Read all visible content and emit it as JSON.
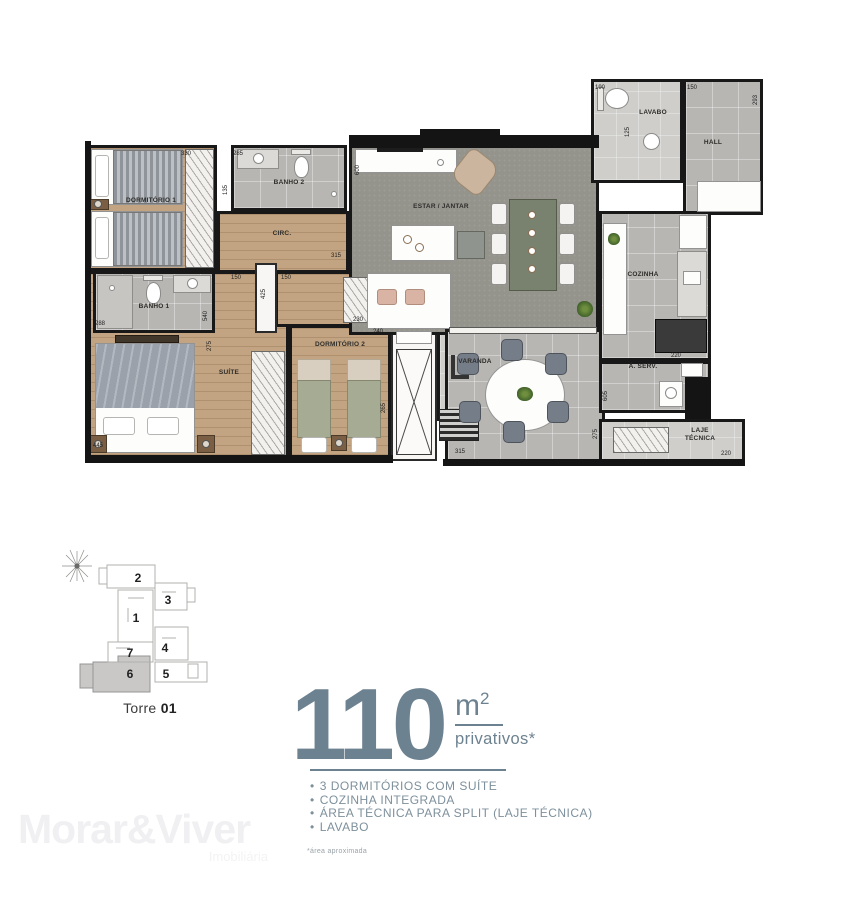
{
  "plan": {
    "rooms": {
      "dorm1": {
        "label": "DORMITÓRIO 1"
      },
      "banho2": {
        "label": "BANHO 2"
      },
      "circ": {
        "label": "CIRC."
      },
      "banho1": {
        "label": "BANHO 1"
      },
      "suite": {
        "label": "SUÍTE"
      },
      "dorm2": {
        "label": "DORMITÓRIO 2"
      },
      "estar": {
        "label": "ESTAR / JANTAR"
      },
      "varanda": {
        "label": "VARANDA"
      },
      "cozinha": {
        "label": "COZINHA"
      },
      "aserv": {
        "label": "Á. SERV."
      },
      "laje": {
        "label": "LAJE TÉCNICA"
      },
      "lavabo": {
        "label": "LAVABO"
      },
      "hall": {
        "label": "HALL"
      }
    },
    "dims": [
      "330",
      "285",
      "135",
      "288",
      "540",
      "150",
      "425",
      "150",
      "315",
      "600",
      "230",
      "240",
      "265",
      "445",
      "275",
      "190",
      "150",
      "125",
      "293",
      "220",
      "605",
      "315",
      "275",
      "220"
    ]
  },
  "keyplan": {
    "tower_label": "Torre",
    "tower_number": "01",
    "units": [
      "1",
      "2",
      "3",
      "4",
      "5",
      "6",
      "7"
    ],
    "highlighted_unit": "6"
  },
  "area": {
    "value": "110",
    "unit": "m",
    "unit_sup": "2",
    "qualifier": "privativos*"
  },
  "features": [
    "3 DORMITÓRIOS COM SUÍTE",
    "COZINHA INTEGRADA",
    "ÁREA TÉCNICA PARA SPLIT (LAJE TÉCNICA)",
    "LAVABO"
  ],
  "footnote": "*área aproximada",
  "watermark": {
    "brand": "Morar&Viver",
    "tagline": "Imobiliária"
  },
  "colors": {
    "accent": "#6d8290",
    "wall": "#141414",
    "wood": "#c2a482",
    "tile": "#b7b6b3",
    "rug": "#95948c"
  }
}
